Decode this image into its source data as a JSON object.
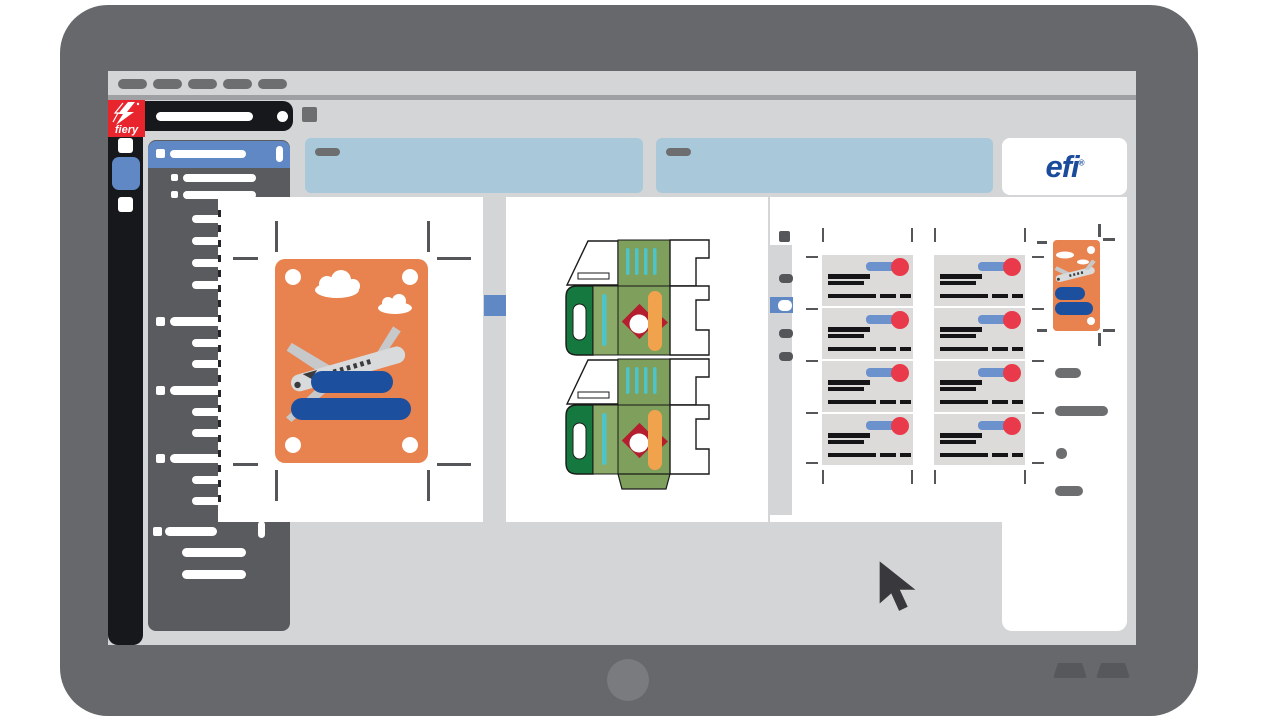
{
  "brand": {
    "fiery_logo_text": "fiery",
    "efi_logo_text": "efi",
    "registered_mark": "®"
  },
  "colors": {
    "accent": "#5f88c4",
    "fiery_red": "#e8252d",
    "efi_blue": "#1b4b9b",
    "panel_blue": "#a9c9da",
    "window_gray": "#d4d5d7",
    "ui_dark": "#17181c",
    "neutral_gray": "#6d6e70",
    "sidebar_gray": "#5a5b5e",
    "mark_gray": "#55565a",
    "frame_gray": "#66686b",
    "card_orange": "#e8824e",
    "navy": "#1c4f9e",
    "olive": "#7f9f5c",
    "deep_green": "#15793f",
    "teal": "#4cc4c9",
    "flag_orange": "#f0a24c",
    "berry_red": "#b41e2e",
    "biz_blue": "#6b92cc",
    "biz_red": "#e93a4c",
    "card_gray": "#dcdbd9"
  },
  "menubar": {
    "pill_count": 5
  },
  "sidebar": {
    "items": [
      {
        "kind": "selected",
        "y": 1
      },
      {
        "kind": "child",
        "y": 34
      },
      {
        "kind": "child",
        "y": 51
      },
      {
        "kind": "sub",
        "y": 75
      },
      {
        "kind": "sub",
        "y": 97
      },
      {
        "kind": "sub",
        "y": 119
      },
      {
        "kind": "sub",
        "y": 141
      },
      {
        "kind": "group",
        "y": 177
      },
      {
        "kind": "sub2",
        "y": 199
      },
      {
        "kind": "sub2",
        "y": 220
      },
      {
        "kind": "group",
        "y": 246
      },
      {
        "kind": "sub2",
        "y": 268
      },
      {
        "kind": "sub2",
        "y": 289
      },
      {
        "kind": "group",
        "y": 314
      },
      {
        "kind": "sub2",
        "y": 336
      },
      {
        "kind": "sub2",
        "y": 357
      },
      {
        "kind": "groupScroll",
        "y": 387
      },
      {
        "kind": "wide",
        "y": 408
      },
      {
        "kind": "wide",
        "y": 430
      }
    ]
  },
  "cards_sheet": {
    "rows": 4,
    "cols": 2
  },
  "pagelist_pills": [
    {
      "x": 1055,
      "y": 368,
      "w": 26,
      "h": 10
    },
    {
      "x": 1055,
      "y": 406,
      "w": 53,
      "h": 10
    },
    {
      "x": 1056,
      "y": 448,
      "w": 11,
      "h": 11
    },
    {
      "x": 1055,
      "y": 486,
      "w": 28,
      "h": 10
    }
  ],
  "cropmarks_sheet3": {
    "col_x": [
      822,
      911,
      934,
      1024
    ],
    "row_y": [
      256,
      308,
      360,
      412,
      462
    ]
  }
}
